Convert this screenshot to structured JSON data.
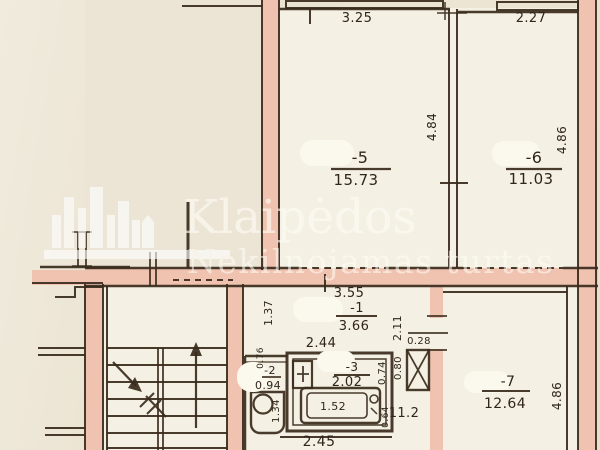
{
  "watermark": {
    "brand_line1": "Klaipėdos",
    "brand_line2": "Nekilnojamas turtas"
  },
  "rooms": {
    "r5": {
      "id": "-5",
      "area": "15.73"
    },
    "r6": {
      "id": "-6",
      "area": "11.03"
    },
    "r7": {
      "id": "-7",
      "area": "12.64"
    },
    "r1": {
      "id": "-1",
      "area": "3.66"
    },
    "r2": {
      "id": "-2",
      "area": "0.94"
    },
    "r3": {
      "id": "-3",
      "area": "2.02"
    }
  },
  "dims": {
    "top_room5": "3.25",
    "top_room6": "2.27",
    "side_room5": "4.84",
    "side_room6": "4.86",
    "side_room7": "4.86",
    "corridor_top": "3.55",
    "corridor_mid": "2.44",
    "corridor_nook": "1.37",
    "corridor_side": "2.11",
    "duct_top": "0.28",
    "duct_side": "0.80",
    "bath_side": "0.74",
    "bath_bottom": "2.45",
    "tub_length": "1.52",
    "wc_side": "1.34",
    "wc_top": "0.76",
    "hall": "11.2",
    "hall_side": "0.64"
  },
  "colors": {
    "wall_fill": "#f0c3b1",
    "line": "#3a2b1c",
    "paper": "#ebe4d3",
    "watermark": "#ffffff"
  }
}
